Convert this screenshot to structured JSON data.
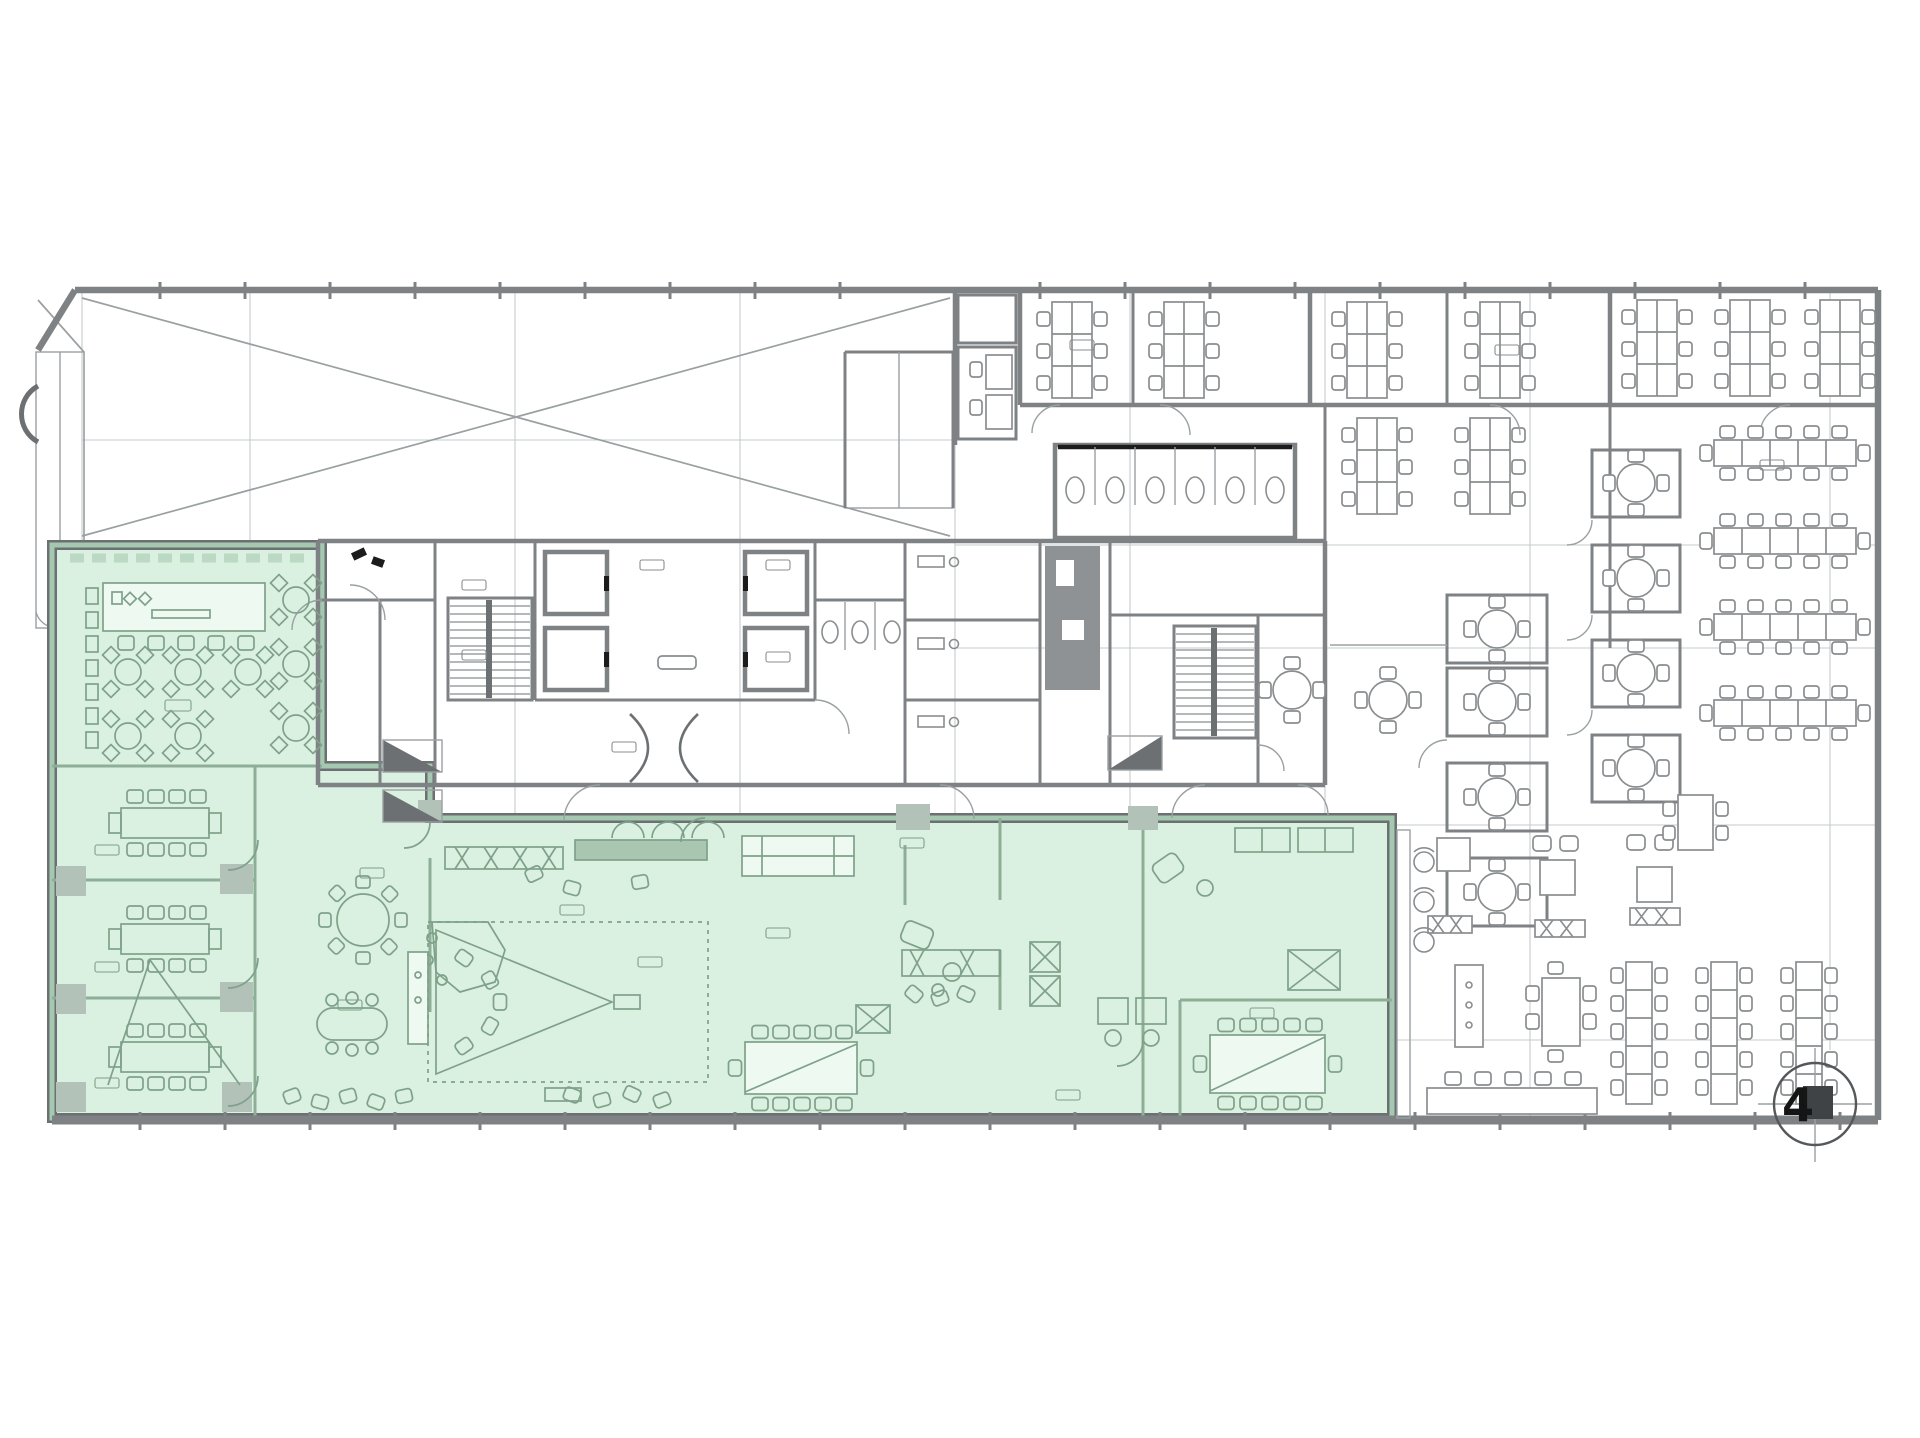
{
  "plan": {
    "kind": "architectural-floor-plan",
    "grid_bubble": {
      "label": "4"
    },
    "highlighted_zones": [
      {
        "id": "canteen-and-meeting-wing",
        "highlighted": true
      },
      {
        "id": "studio-open-space-wing",
        "highlighted": true
      },
      {
        "id": "office-areas",
        "highlighted": false
      }
    ]
  },
  "colors": {
    "bg": "#ffffff",
    "wall": "#7f8284",
    "wallDark": "#6d7072",
    "thin": "#9aa0a2",
    "grid": "#c6cbcc",
    "furn": "#8a8d8f",
    "black": "#1c1c1c",
    "hlFill": "#daf0e1",
    "hlEdge": "#a5c9b0",
    "hlWall": "#8fae97",
    "hlFurn": "#7fa189",
    "hlBlock": "#b3c2b9",
    "bubble": "#3f4345"
  }
}
